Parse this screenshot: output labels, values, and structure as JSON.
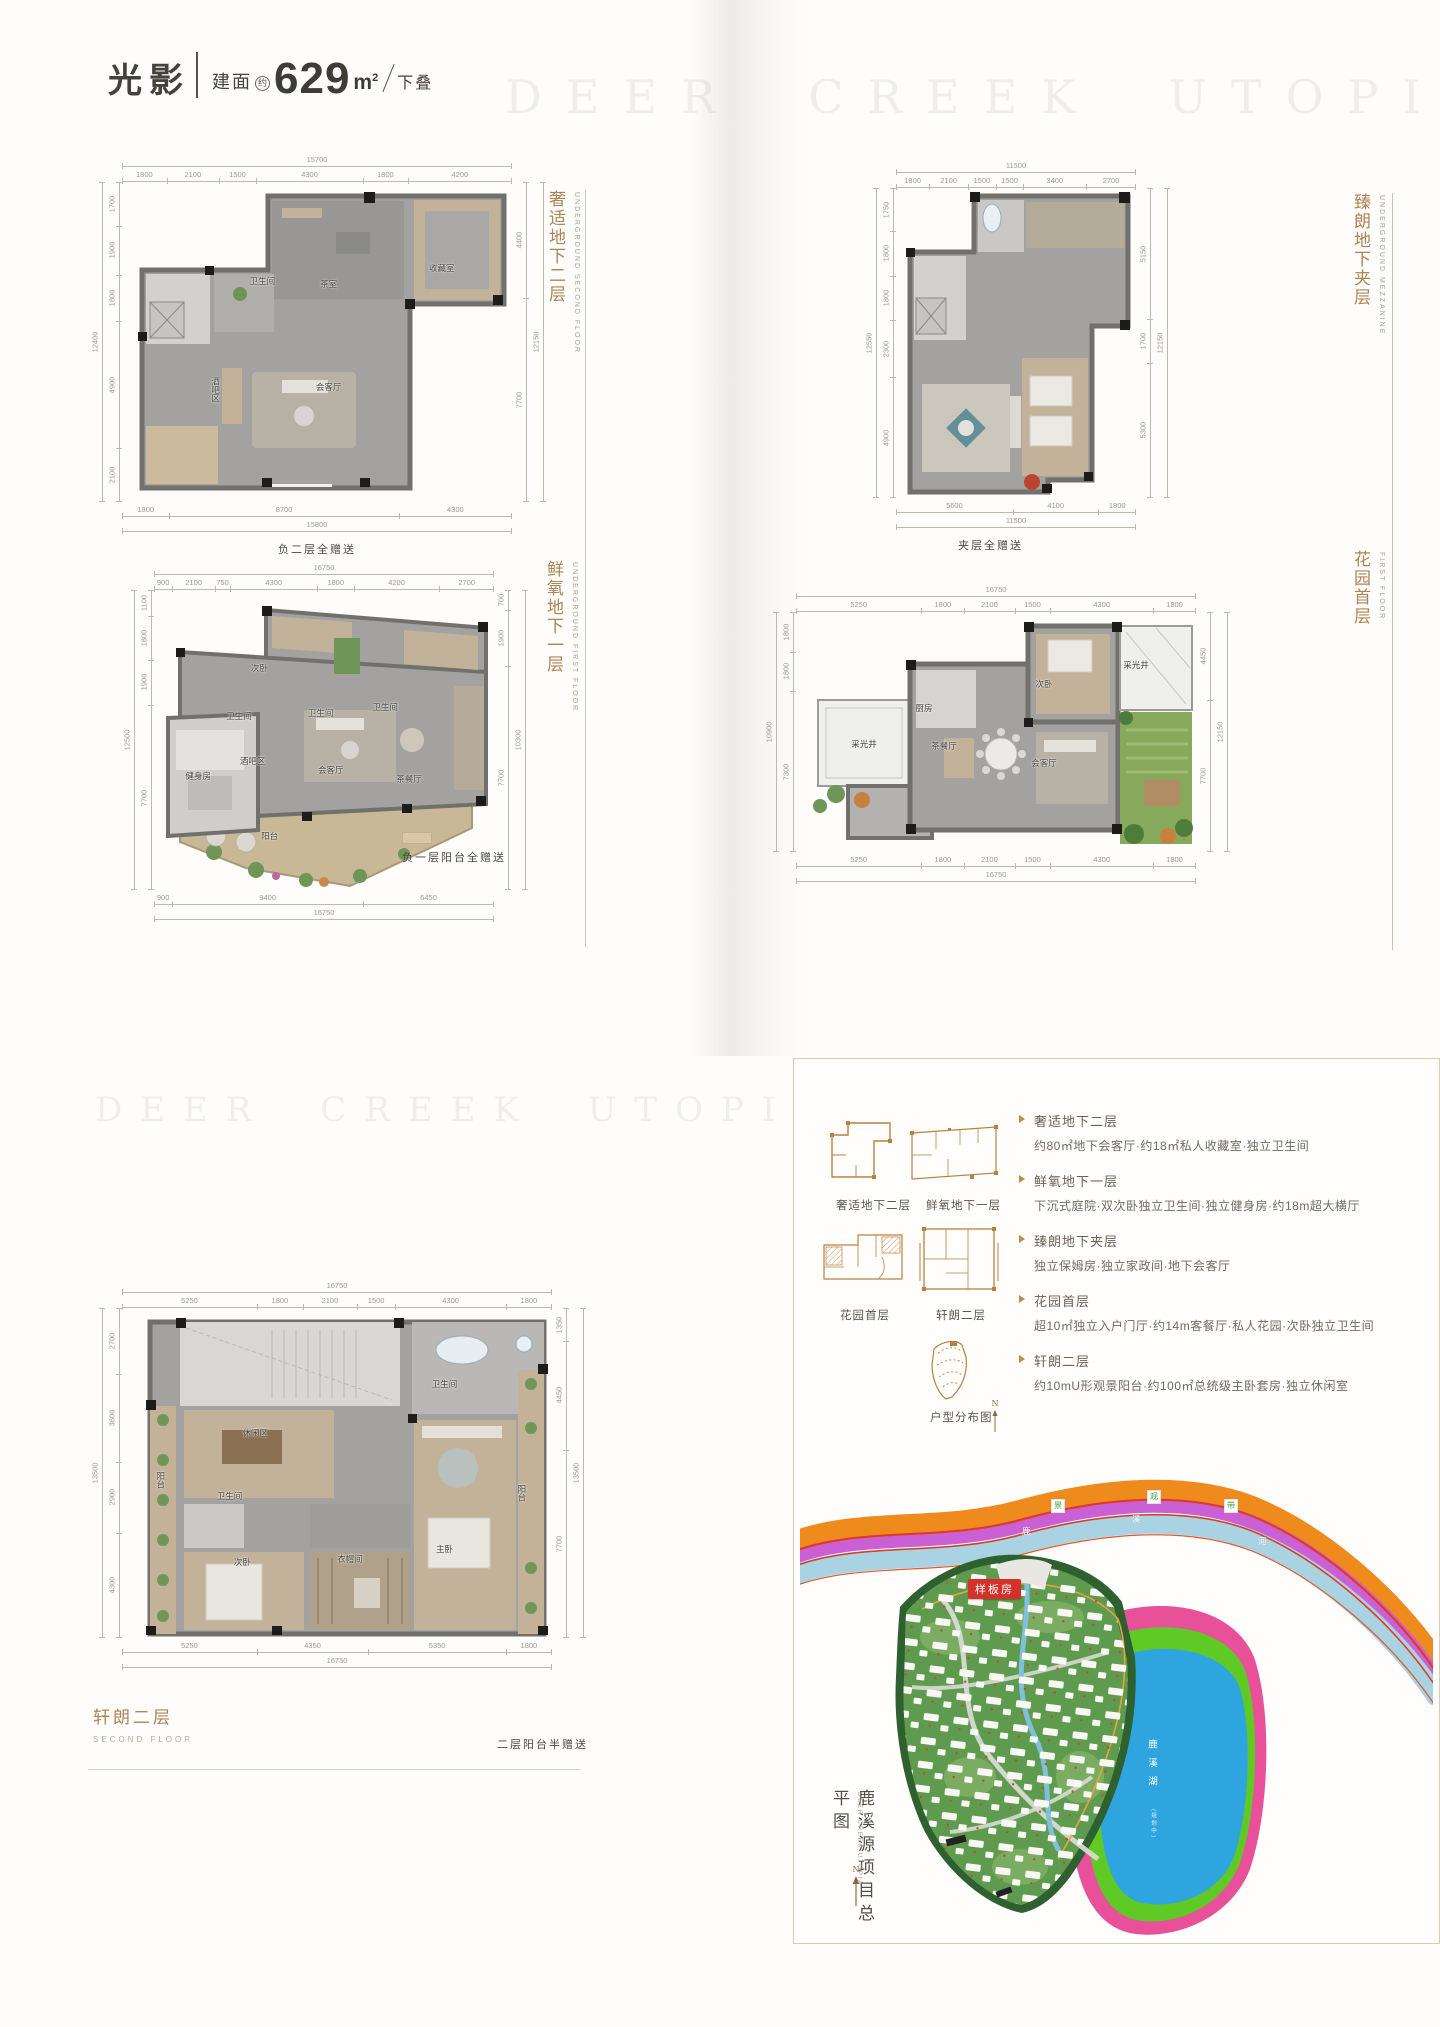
{
  "header": {
    "title": "光影",
    "area_label": "建面",
    "area_approx": "约",
    "area_value": "629",
    "area_unit": "m",
    "area_exp": "2",
    "type_label": "下叠"
  },
  "watermark_top": "DEER CREEK UTOPIA",
  "watermark_mid": "DEER CREEK UTOPIA",
  "plans": [
    {
      "label": "奢适地下二层",
      "label_en": "UNDERGROUND SECOND FLOOR",
      "caption": "负二层全赠送",
      "rooms": [
        {
          "name": "卫生间",
          "x": 36,
          "y": 31
        },
        {
          "name": "茶室",
          "x": 53,
          "y": 32
        },
        {
          "name": "收藏室",
          "x": 82,
          "y": 27
        },
        {
          "name": "会客厅",
          "x": 53,
          "y": 64
        },
        {
          "name": "酒吧区",
          "x": 24,
          "y": 65,
          "v": true
        }
      ],
      "dims": {
        "top": {
          "segs": [
            "1800",
            "2100",
            "1500",
            "4300",
            "1800",
            "4200"
          ],
          "total": "15700"
        },
        "bottom": {
          "segs": [
            "1800",
            "8700",
            "4300"
          ],
          "total": "15800"
        },
        "left": {
          "segs": [
            "1700",
            "1900",
            "1800",
            "4900",
            "2100"
          ],
          "total": "12400"
        },
        "right": {
          "segs": [
            "4400",
            "7700"
          ],
          "total": "12150"
        }
      }
    },
    {
      "label": "臻朗地下夹层",
      "label_en": "UNDERGROUND MEZZANINE",
      "caption": "夹层全赠送",
      "rooms": [],
      "dims": {
        "top": {
          "segs": [
            "1800",
            "2100",
            "1500",
            "1500",
            "3400",
            "2700"
          ],
          "total": "11500"
        },
        "bottom": {
          "segs": [
            "5600",
            "4100",
            "1800"
          ],
          "total": "11500"
        },
        "left": {
          "segs": [
            "1750",
            "1800",
            "1800",
            "2300",
            "4900"
          ],
          "total": "12550"
        },
        "right": {
          "segs": [
            "5150",
            "1700",
            "5300"
          ],
          "total": "12150"
        }
      }
    },
    {
      "label": "鲜氧地下一层",
      "label_en": "UNDERGROUND FIRST FLOOR",
      "caption": "负一层阳台全赠送",
      "rooms": [
        {
          "name": "次卧",
          "x": 31,
          "y": 26
        },
        {
          "name": "卫生间",
          "x": 25,
          "y": 42
        },
        {
          "name": "卫生间",
          "x": 49,
          "y": 41
        },
        {
          "name": "卫生间",
          "x": 68,
          "y": 39
        },
        {
          "name": "健身房",
          "x": 13,
          "y": 62
        },
        {
          "name": "酒吧区",
          "x": 29,
          "y": 57
        },
        {
          "name": "会客厅",
          "x": 52,
          "y": 60
        },
        {
          "name": "茶餐厅",
          "x": 75,
          "y": 63
        },
        {
          "name": "阳台",
          "x": 34,
          "y": 82
        }
      ],
      "dims": {
        "top": {
          "segs": [
            "900",
            "2100",
            "750",
            "4300",
            "1800",
            "4200",
            "2700"
          ],
          "total": "16750"
        },
        "bottom": {
          "segs": [
            "900",
            "9400",
            "6450"
          ],
          "total": "16750"
        },
        "left": {
          "segs": [
            "1100",
            "1800",
            "1900",
            "7700"
          ],
          "total": "12500"
        },
        "right": {
          "segs": [
            "700",
            "1900",
            "7700"
          ],
          "total": "10300"
        }
      }
    },
    {
      "label": "花园首层",
      "label_en": "FIRST FLOOR",
      "caption": "",
      "rooms": [
        {
          "name": "采光井",
          "x": 17,
          "y": 55
        },
        {
          "name": "厨房",
          "x": 32,
          "y": 40
        },
        {
          "name": "茶餐厅",
          "x": 37,
          "y": 56
        },
        {
          "name": "次卧",
          "x": 62,
          "y": 30
        },
        {
          "name": "会客厅",
          "x": 62,
          "y": 63
        },
        {
          "name": "采光井",
          "x": 85,
          "y": 22
        }
      ],
      "dims": {
        "top": {
          "segs": [
            "5250",
            "1800",
            "2100",
            "1500",
            "4300",
            "1800"
          ],
          "total": "16750"
        },
        "bottom": {
          "segs": [
            "5250",
            "1800",
            "2100",
            "1500",
            "4300",
            "1800"
          ],
          "total": "16750"
        },
        "left": {
          "segs": [
            "1800",
            "1800",
            "7300"
          ],
          "total": "10900"
        },
        "right": {
          "segs": [
            "4450",
            "7700"
          ],
          "total": "12150"
        }
      }
    },
    {
      "label": "轩朗二层",
      "label_en": "SECOND FLOOR",
      "caption": "",
      "rooms": [
        {
          "name": "休闲区",
          "x": 31,
          "y": 38
        },
        {
          "name": "卫生间",
          "x": 25,
          "y": 57
        },
        {
          "name": "次卧",
          "x": 28,
          "y": 77
        },
        {
          "name": "衣帽间",
          "x": 53,
          "y": 76
        },
        {
          "name": "主卧",
          "x": 75,
          "y": 73
        },
        {
          "name": "卫生间",
          "x": 75,
          "y": 23
        },
        {
          "name": "阳台",
          "x": 9,
          "y": 52,
          "v": true
        },
        {
          "name": "阳台",
          "x": 93,
          "y": 56,
          "v": true
        }
      ],
      "dims": {
        "top": {
          "segs": [
            "5250",
            "1800",
            "2100",
            "1500",
            "4300",
            "1800"
          ],
          "total": "16750"
        },
        "bottom": {
          "segs": [
            "5250",
            "4350",
            "5350",
            "1800"
          ],
          "total": "16750"
        },
        "left": {
          "segs": [
            "2700",
            "3600",
            "2900",
            "4300"
          ],
          "total": "13500"
        },
        "right": {
          "segs": [
            "1350",
            "4450",
            "7700"
          ],
          "total": "13500"
        }
      }
    }
  ],
  "footer": {
    "label": "轩朗二层",
    "label_en": "SECOND FLOOR",
    "caption": "二层阳台半赠送"
  },
  "panel": {
    "thumbs": [
      {
        "label": "奢适地下二层"
      },
      {
        "label": "鲜氧地下一层"
      },
      {
        "label": "花园首层"
      },
      {
        "label": "轩朗二层"
      }
    ],
    "distribution": {
      "label": "户型分布图",
      "north": "N"
    },
    "bullets": [
      {
        "title": "奢适地下二层",
        "desc": "约80㎡地下会客厅·约18㎡私人收藏室·独立卫生间"
      },
      {
        "title": "鲜氧地下一层",
        "desc": "下沉式庭院·双次卧独立卫生间·独立健身房·约18m超大横厅"
      },
      {
        "title": "臻朗地下夹层",
        "desc": "独立保姆房·独立家政间·地下会客厅"
      },
      {
        "title": "花园首层",
        "desc": "超10㎡独立入户门厅·约14m客餐厅·私人花园·次卧独立卫生间"
      },
      {
        "title": "轩朗二层",
        "desc": "约10mU形观景阳台·约100㎡总统级主卧套房·独立休闲室"
      }
    ],
    "site": {
      "title_vertical": "鹿溪源项目总平图",
      "subtitle_vertical": "DEER CREEK UTOPIA",
      "north": "N",
      "sample_badge": "样板房",
      "river_chars": [
        "鹿",
        "溪",
        "河"
      ],
      "greenway_chars": [
        "景",
        "观",
        "带"
      ],
      "lake": "鹿溪湖",
      "lake_note": "(规划中)"
    }
  },
  "colors": {
    "accent_brown": "#ad8453",
    "badge_red": "#d5312c",
    "river_blue": "#a9d3e3",
    "greenway_purple": "#cb5fd4",
    "road_orange": "#ef8a1d",
    "lake_blue": "#2ea5de",
    "lake_green": "#5fc926",
    "lake_pink": "#e8519a"
  }
}
